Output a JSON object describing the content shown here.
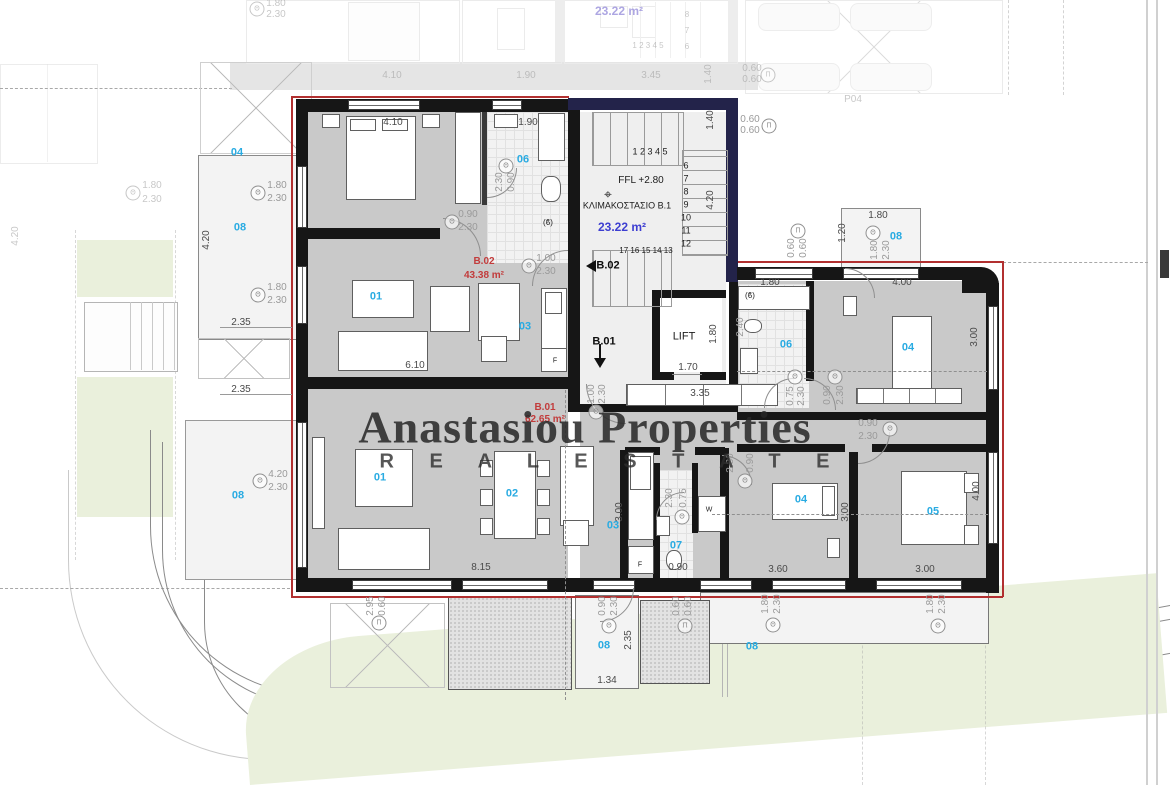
{
  "watermark": {
    "title": "Anastasiou Properties",
    "subtitle": "R E A L   E S T A T E"
  },
  "summary": {
    "units": [
      {
        "id": "B.02",
        "area": "43.38 m²"
      },
      {
        "id": "B.01",
        "area": "62.65 m²"
      }
    ],
    "stairwell": {
      "name": "ΚΛΙΜΑΚΟΣΤΑΣΙΟ B.1",
      "area": "23.22 m²",
      "floor_level": "FFL +2.80"
    },
    "lift": "LIFT",
    "upper_floor_ghost": {
      "area": "23.22 m²",
      "parking_space": "P04"
    },
    "room_numbers_legend": [
      "01",
      "02",
      "03",
      "04",
      "05",
      "06",
      "07",
      "08"
    ]
  },
  "colors": {
    "room_label": "#29abe2",
    "area_label": "#3d3ed1",
    "red_label": "#c23b3b",
    "wall": "#161616",
    "navy_wall": "#23234a",
    "red_boundary": "#b23030",
    "floor_gray": "#c9c9c9",
    "lawn_green": "#eaf0dc"
  },
  "labels": [
    {
      "t": "04",
      "x": 237,
      "y": 153,
      "c": "b"
    },
    {
      "t": "06",
      "x": 523,
      "y": 160,
      "c": "b"
    },
    {
      "t": "08",
      "x": 240,
      "y": 228,
      "c": "b"
    },
    {
      "t": "01",
      "x": 376,
      "y": 297,
      "c": "b"
    },
    {
      "t": "03",
      "x": 525,
      "y": 327,
      "c": "b"
    },
    {
      "t": "08",
      "x": 896,
      "y": 237,
      "c": "b"
    },
    {
      "t": "06",
      "x": 786,
      "y": 345,
      "c": "b"
    },
    {
      "t": "04",
      "x": 908,
      "y": 348,
      "c": "b"
    },
    {
      "t": "08",
      "x": 238,
      "y": 496,
      "c": "b"
    },
    {
      "t": "01",
      "x": 380,
      "y": 478,
      "c": "b"
    },
    {
      "t": "02",
      "x": 512,
      "y": 494,
      "c": "b"
    },
    {
      "t": "03",
      "x": 613,
      "y": 526,
      "c": "b"
    },
    {
      "t": "07",
      "x": 676,
      "y": 546,
      "c": "b"
    },
    {
      "t": "04",
      "x": 801,
      "y": 500,
      "c": "b"
    },
    {
      "t": "05",
      "x": 933,
      "y": 512,
      "c": "b"
    },
    {
      "t": "08",
      "x": 604,
      "y": 646,
      "c": "b"
    },
    {
      "t": "08",
      "x": 752,
      "y": 647,
      "c": "b"
    },
    {
      "t": "FFL +2.80",
      "x": 641,
      "y": 181,
      "c": "k"
    },
    {
      "t": "ΚΛΙΜΑΚΟΣΤΑΣΙΟ B.1",
      "x": 627,
      "y": 206,
      "c": "k",
      "fs": 9
    },
    {
      "t": "23.22 m²",
      "x": 622,
      "y": 227,
      "c": "bl"
    },
    {
      "t": "LIFT",
      "x": 684,
      "y": 337,
      "c": "k",
      "fs": 11
    },
    {
      "t": "B.02",
      "x": 608,
      "y": 266,
      "c": "k8"
    },
    {
      "t": "B.01",
      "x": 604,
      "y": 342,
      "c": "k8"
    },
    {
      "t": "1 2 3 4 5",
      "x": 650,
      "y": 152,
      "c": "k",
      "fs": 9
    },
    {
      "t": "6",
      "x": 686,
      "y": 166,
      "c": "k",
      "fs": 9
    },
    {
      "t": "7",
      "x": 686,
      "y": 179,
      "c": "k",
      "fs": 9
    },
    {
      "t": "8",
      "x": 686,
      "y": 192,
      "c": "k",
      "fs": 9
    },
    {
      "t": "9",
      "x": 686,
      "y": 205,
      "c": "k",
      "fs": 9
    },
    {
      "t": "10",
      "x": 686,
      "y": 218,
      "c": "k",
      "fs": 9
    },
    {
      "t": "11",
      "x": 686,
      "y": 231,
      "c": "k",
      "fs": 9
    },
    {
      "t": "12",
      "x": 686,
      "y": 244,
      "c": "k",
      "fs": 9
    },
    {
      "t": "17 16 15 14 13",
      "x": 646,
      "y": 251,
      "c": "k",
      "fs": 8
    },
    {
      "t": "B.02",
      "x": 484,
      "y": 262,
      "c": "r"
    },
    {
      "t": "43.38 m²",
      "x": 484,
      "y": 276,
      "c": "r"
    },
    {
      "t": "B.01",
      "x": 545,
      "y": 408,
      "c": "r"
    },
    {
      "t": "62.65 m²",
      "x": 545,
      "y": 420,
      "c": "r"
    },
    {
      "t": "4.10",
      "x": 393,
      "y": 123,
      "c": "d"
    },
    {
      "t": "1.90",
      "x": 528,
      "y": 123,
      "c": "d"
    },
    {
      "t": "1.80",
      "x": 770,
      "y": 283,
      "c": "d"
    },
    {
      "t": "4.00",
      "x": 902,
      "y": 283,
      "c": "d"
    },
    {
      "t": "1.80",
      "x": 878,
      "y": 216,
      "c": "d"
    },
    {
      "t": "6.10",
      "x": 415,
      "y": 366,
      "c": "d"
    },
    {
      "t": "3.35",
      "x": 700,
      "y": 394,
      "c": "d"
    },
    {
      "t": "1.70",
      "x": 688,
      "y": 368,
      "c": "d"
    },
    {
      "t": "8.15",
      "x": 481,
      "y": 568,
      "c": "d"
    },
    {
      "t": "0.90",
      "x": 678,
      "y": 568,
      "c": "d"
    },
    {
      "t": "3.60",
      "x": 778,
      "y": 570,
      "c": "d"
    },
    {
      "t": "3.00",
      "x": 925,
      "y": 570,
      "c": "d"
    },
    {
      "t": "2.35",
      "x": 241,
      "y": 323,
      "c": "d"
    },
    {
      "t": "2.35",
      "x": 241,
      "y": 390,
      "c": "d"
    },
    {
      "t": "1.34",
      "x": 607,
      "y": 681,
      "c": "d"
    },
    {
      "t": "1.40",
      "x": 711,
      "y": 120,
      "c": "d",
      "rot": 1
    },
    {
      "t": "4.20",
      "x": 711,
      "y": 200,
      "c": "d",
      "rot": 1
    },
    {
      "t": "1.80",
      "x": 714,
      "y": 334,
      "c": "d",
      "rot": 1
    },
    {
      "t": "3.00",
      "x": 975,
      "y": 337,
      "c": "d",
      "rot": 1
    },
    {
      "t": "4.00",
      "x": 977,
      "y": 491,
      "c": "d",
      "rot": 1
    },
    {
      "t": "3.00",
      "x": 846,
      "y": 512,
      "c": "d",
      "rot": 1
    },
    {
      "t": "3.00",
      "x": 620,
      "y": 512,
      "c": "d",
      "rot": 1
    },
    {
      "t": "1.20",
      "x": 843,
      "y": 233,
      "c": "d",
      "rot": 1
    },
    {
      "t": "2.35",
      "x": 629,
      "y": 640,
      "c": "d",
      "rot": 1
    },
    {
      "t": "4.20",
      "x": 207,
      "y": 240,
      "c": "d",
      "rot": 1
    },
    {
      "t": "2.40",
      "x": 741,
      "y": 327,
      "c": "l",
      "rot": 1
    },
    {
      "t": "1.80",
      "x": 277,
      "y": 186,
      "c": "l"
    },
    {
      "t": "2.30",
      "x": 277,
      "y": 199,
      "c": "l"
    },
    {
      "t": "1.80",
      "x": 277,
      "y": 288,
      "c": "l"
    },
    {
      "t": "2.30",
      "x": 277,
      "y": 301,
      "c": "l"
    },
    {
      "t": "0.90",
      "x": 468,
      "y": 215,
      "c": "l"
    },
    {
      "t": "2.30",
      "x": 468,
      "y": 228,
      "c": "l"
    },
    {
      "t": "2.30",
      "x": 500,
      "y": 182,
      "c": "l",
      "rot": 1
    },
    {
      "t": "0.90",
      "x": 512,
      "y": 182,
      "c": "l",
      "rot": 1
    },
    {
      "t": "1.00",
      "x": 546,
      "y": 259,
      "c": "l"
    },
    {
      "t": "2.30",
      "x": 546,
      "y": 272,
      "c": "l"
    },
    {
      "t": "1.00",
      "x": 592,
      "y": 394,
      "c": "l",
      "rot": 1
    },
    {
      "t": "2.30",
      "x": 603,
      "y": 394,
      "c": "l",
      "rot": 1
    },
    {
      "t": "0.75",
      "x": 791,
      "y": 396,
      "c": "l",
      "rot": 1
    },
    {
      "t": "2.30",
      "x": 802,
      "y": 396,
      "c": "l",
      "rot": 1
    },
    {
      "t": "0.90",
      "x": 828,
      "y": 395,
      "c": "l",
      "rot": 1
    },
    {
      "t": "2.30",
      "x": 841,
      "y": 395,
      "c": "l",
      "rot": 1
    },
    {
      "t": "0.90",
      "x": 868,
      "y": 424,
      "c": "l"
    },
    {
      "t": "2.30",
      "x": 868,
      "y": 437,
      "c": "l"
    },
    {
      "t": "2.30",
      "x": 731,
      "y": 463,
      "c": "l",
      "rot": 1
    },
    {
      "t": "0.90",
      "x": 751,
      "y": 463,
      "c": "l",
      "rot": 1
    },
    {
      "t": "2.30",
      "x": 670,
      "y": 498,
      "c": "l",
      "rot": 1
    },
    {
      "t": "0.75",
      "x": 684,
      "y": 498,
      "c": "l",
      "rot": 1
    },
    {
      "t": "4.20",
      "x": 278,
      "y": 475,
      "c": "l"
    },
    {
      "t": "2.30",
      "x": 278,
      "y": 488,
      "c": "l"
    },
    {
      "t": "2.95",
      "x": 371,
      "y": 606,
      "c": "l",
      "rot": 1
    },
    {
      "t": "0.60",
      "x": 383,
      "y": 606,
      "c": "l",
      "rot": 1
    },
    {
      "t": "0.90",
      "x": 603,
      "y": 606,
      "c": "l",
      "rot": 1
    },
    {
      "t": "2.30",
      "x": 615,
      "y": 606,
      "c": "l",
      "rot": 1
    },
    {
      "t": "0.60",
      "x": 677,
      "y": 606,
      "c": "l",
      "rot": 1
    },
    {
      "t": "0.60",
      "x": 689,
      "y": 606,
      "c": "l",
      "rot": 1
    },
    {
      "t": "1.80",
      "x": 766,
      "y": 604,
      "c": "l",
      "rot": 1
    },
    {
      "t": "2.30",
      "x": 778,
      "y": 604,
      "c": "l",
      "rot": 1
    },
    {
      "t": "1.80",
      "x": 931,
      "y": 604,
      "c": "l",
      "rot": 1
    },
    {
      "t": "2.30",
      "x": 943,
      "y": 604,
      "c": "l",
      "rot": 1
    },
    {
      "t": "1.80",
      "x": 875,
      "y": 250,
      "c": "l",
      "rot": 1
    },
    {
      "t": "2.30",
      "x": 887,
      "y": 250,
      "c": "l",
      "rot": 1
    },
    {
      "t": "0.60",
      "x": 792,
      "y": 248,
      "c": "l",
      "rot": 1
    },
    {
      "t": "0.60",
      "x": 804,
      "y": 248,
      "c": "l",
      "rot": 1
    },
    {
      "t": "0.60",
      "x": 750,
      "y": 120,
      "c": "l"
    },
    {
      "t": "0.60",
      "x": 750,
      "y": 131,
      "c": "l"
    },
    {
      "t": "1.80",
      "x": 276,
      "y": 4,
      "c": "f"
    },
    {
      "t": "2.30",
      "x": 276,
      "y": 15,
      "c": "f"
    },
    {
      "t": "1.80",
      "x": 152,
      "y": 186,
      "c": "f"
    },
    {
      "t": "2.30",
      "x": 152,
      "y": 200,
      "c": "f"
    },
    {
      "t": "4.20",
      "x": 16,
      "y": 236,
      "c": "f",
      "rot": 1
    },
    {
      "t": "4.10",
      "x": 392,
      "y": 76,
      "c": "f"
    },
    {
      "t": "1.90",
      "x": 526,
      "y": 76,
      "c": "f"
    },
    {
      "t": "3.45",
      "x": 651,
      "y": 76,
      "c": "f"
    },
    {
      "t": "1.40",
      "x": 709,
      "y": 74,
      "c": "f",
      "rot": 1
    },
    {
      "t": "0.60",
      "x": 752,
      "y": 69,
      "c": "f"
    },
    {
      "t": "0.60",
      "x": 752,
      "y": 80,
      "c": "f"
    },
    {
      "t": "P04",
      "x": 853,
      "y": 100,
      "c": "f"
    },
    {
      "t": "1 2 3 4 5",
      "x": 648,
      "y": 46,
      "c": "f",
      "fs": 8
    },
    {
      "t": "8",
      "x": 687,
      "y": 15,
      "c": "f",
      "fs": 8
    },
    {
      "t": "7",
      "x": 687,
      "y": 31,
      "c": "f",
      "fs": 8
    },
    {
      "t": "6",
      "x": 687,
      "y": 47,
      "c": "f",
      "fs": 8
    },
    {
      "t": "23.22 m²",
      "x": 619,
      "y": 11,
      "c": "fp"
    },
    {
      "t": "W",
      "x": 709,
      "y": 510,
      "c": "k",
      "fs": 7
    },
    {
      "t": "F",
      "x": 555,
      "y": 361,
      "c": "k",
      "fs": 7
    },
    {
      "t": "F",
      "x": 640,
      "y": 565,
      "c": "k",
      "fs": 7
    },
    {
      "t": "(ϐ)",
      "x": 548,
      "y": 223,
      "c": "k",
      "fs": 8
    },
    {
      "t": "(ϐ)",
      "x": 750,
      "y": 296,
      "c": "k",
      "fs": 8
    }
  ],
  "symbols": [
    {
      "g": "Θ",
      "x": 258,
      "y": 193
    },
    {
      "g": "Θ",
      "x": 258,
      "y": 295
    },
    {
      "g": "Θ",
      "x": 452,
      "y": 222
    },
    {
      "g": "Θ",
      "x": 506,
      "y": 166
    },
    {
      "g": "Θ",
      "x": 529,
      "y": 266
    },
    {
      "g": "Θ",
      "x": 596,
      "y": 412
    },
    {
      "g": "Θ",
      "x": 795,
      "y": 377
    },
    {
      "g": "Θ",
      "x": 835,
      "y": 377
    },
    {
      "g": "Θ",
      "x": 890,
      "y": 429
    },
    {
      "g": "Θ",
      "x": 745,
      "y": 481
    },
    {
      "g": "Θ",
      "x": 682,
      "y": 517
    },
    {
      "g": "Θ",
      "x": 260,
      "y": 481
    },
    {
      "g": "Θ",
      "x": 609,
      "y": 626
    },
    {
      "g": "Θ",
      "x": 773,
      "y": 625
    },
    {
      "g": "Θ",
      "x": 938,
      "y": 626
    },
    {
      "g": "Θ",
      "x": 873,
      "y": 233
    },
    {
      "g": "Π",
      "x": 379,
      "y": 623
    },
    {
      "g": "Π",
      "x": 685,
      "y": 626
    },
    {
      "g": "Π",
      "x": 769,
      "y": 126
    },
    {
      "g": "Π",
      "x": 798,
      "y": 231
    },
    {
      "g": "Θ",
      "x": 133,
      "y": 193,
      "f": 1
    },
    {
      "g": "Θ",
      "x": 257,
      "y": 9,
      "f": 1
    },
    {
      "g": "Π",
      "x": 768,
      "y": 75,
      "f": 1
    }
  ]
}
